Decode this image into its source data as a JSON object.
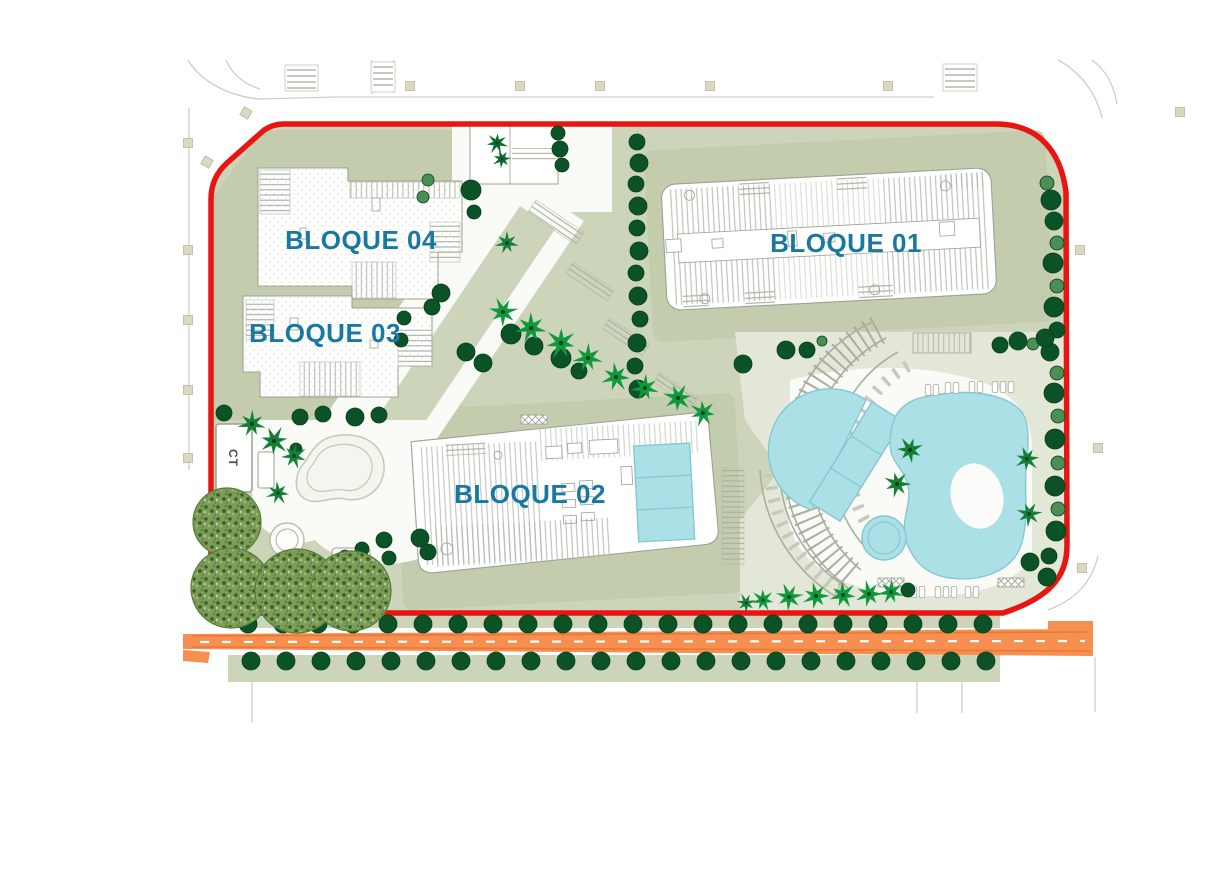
{
  "title": "Residential complex site plan",
  "labels": {
    "b01": "BLOQUE 01",
    "b02": "BLOQUE 02",
    "b03": "BLOQUE 03",
    "b04": "BLOQUE 04",
    "ct": "CT"
  },
  "colors": {
    "red": "#e81510",
    "sage": "#ccd5ba",
    "sageD": "#c3cdae",
    "deck": "#e3e7d8",
    "walk": "#fafbf7",
    "pool": "#abe0e7",
    "poolStroke": "#85c8d2",
    "road": "#f78f50",
    "roadEdge": "#e87a35",
    "label": "#1878a1",
    "bstroke": "#9ca294",
    "street": "#cdd0c5",
    "beige": "#ddd8c2",
    "treeDark": "#0c5227",
    "treeLight": "#4c8f54",
    "palmBright": "#10993c",
    "palmMid": "#157f38",
    "palmDark": "#0b6c2f",
    "canopyBase": "#7d9c58",
    "canopyEdge": "#55803a"
  },
  "trees": {
    "round": [
      [
        1047,
        183,
        7,
        "l"
      ],
      [
        1051,
        200,
        10,
        "d"
      ],
      [
        1054,
        221,
        9,
        "d"
      ],
      [
        1057,
        243,
        7,
        "l"
      ],
      [
        1053,
        263,
        10,
        "d"
      ],
      [
        1057,
        286,
        7,
        "l"
      ],
      [
        1054,
        307,
        10,
        "d"
      ],
      [
        1057,
        330,
        8,
        "d"
      ],
      [
        1050,
        352,
        9,
        "d"
      ],
      [
        1057,
        373,
        7,
        "l"
      ],
      [
        1054,
        393,
        10,
        "d"
      ],
      [
        1058,
        416,
        7,
        "l"
      ],
      [
        1055,
        439,
        10,
        "d"
      ],
      [
        1058,
        463,
        7,
        "l"
      ],
      [
        1055,
        486,
        10,
        "d"
      ],
      [
        1058,
        509,
        7,
        "l"
      ],
      [
        1056,
        531,
        10,
        "d"
      ],
      [
        1049,
        556,
        8,
        "d"
      ],
      [
        1047,
        577,
        9,
        "d"
      ],
      [
        1000,
        345,
        8,
        "d"
      ],
      [
        1018,
        341,
        9,
        "d"
      ],
      [
        1033,
        344,
        6,
        "l"
      ],
      [
        1045,
        338,
        9,
        "d"
      ],
      [
        637,
        142,
        8,
        "d"
      ],
      [
        639,
        163,
        9,
        "d"
      ],
      [
        636,
        184,
        8,
        "d"
      ],
      [
        638,
        206,
        9,
        "d"
      ],
      [
        637,
        228,
        8,
        "d"
      ],
      [
        639,
        251,
        9,
        "d"
      ],
      [
        636,
        273,
        8,
        "d"
      ],
      [
        638,
        296,
        9,
        "d"
      ],
      [
        640,
        319,
        8,
        "d"
      ],
      [
        637,
        343,
        9,
        "d"
      ],
      [
        635,
        366,
        8,
        "d"
      ],
      [
        638,
        389,
        9,
        "d"
      ],
      [
        441,
        293,
        9,
        "d"
      ],
      [
        432,
        307,
        8,
        "d"
      ],
      [
        466,
        352,
        9,
        "d"
      ],
      [
        483,
        363,
        9,
        "d"
      ],
      [
        511,
        334,
        10,
        "d"
      ],
      [
        534,
        346,
        9,
        "d"
      ],
      [
        561,
        358,
        10,
        "d"
      ],
      [
        579,
        371,
        8,
        "d"
      ],
      [
        404,
        318,
        7,
        "d"
      ],
      [
        401,
        340,
        7,
        "d"
      ],
      [
        428,
        180,
        6,
        "l"
      ],
      [
        423,
        197,
        6,
        "l"
      ],
      [
        471,
        190,
        10,
        "d"
      ],
      [
        474,
        212,
        7,
        "d"
      ],
      [
        558,
        133,
        7,
        "d"
      ],
      [
        560,
        149,
        8,
        "d"
      ],
      [
        562,
        165,
        7,
        "d"
      ],
      [
        786,
        350,
        9,
        "d"
      ],
      [
        807,
        350,
        8,
        "d"
      ],
      [
        822,
        341,
        5,
        "l"
      ],
      [
        743,
        364,
        9,
        "d"
      ],
      [
        224,
        413,
        8,
        "d"
      ],
      [
        300,
        417,
        8,
        "d"
      ],
      [
        323,
        414,
        8,
        "d"
      ],
      [
        355,
        417,
        9,
        "d"
      ],
      [
        379,
        415,
        8,
        "d"
      ],
      [
        296,
        449,
        6,
        "d"
      ],
      [
        384,
        540,
        8,
        "d"
      ],
      [
        362,
        549,
        7,
        "d"
      ],
      [
        389,
        558,
        7,
        "d"
      ],
      [
        345,
        556,
        6,
        "d"
      ],
      [
        420,
        538,
        9,
        "d"
      ],
      [
        428,
        552,
        8,
        "d"
      ],
      [
        908,
        590,
        7,
        "d"
      ],
      [
        1030,
        562,
        9,
        "d"
      ]
    ],
    "bottomRows": [
      {
        "y": 624,
        "x0": 248,
        "step": 35,
        "n": 22,
        "r": 9
      },
      {
        "y": 661,
        "x0": 251,
        "step": 35,
        "n": 22,
        "r": 9
      }
    ],
    "palms": [
      [
        503,
        312,
        15,
        "b"
      ],
      [
        531,
        328,
        16,
        "b"
      ],
      [
        561,
        343,
        16,
        "b"
      ],
      [
        588,
        358,
        15,
        "b"
      ],
      [
        616,
        377,
        15,
        "b"
      ],
      [
        645,
        388,
        14,
        "b"
      ],
      [
        678,
        398,
        15,
        "b"
      ],
      [
        703,
        413,
        14,
        "b"
      ],
      [
        507,
        243,
        12,
        "m"
      ],
      [
        497,
        143,
        11,
        "d"
      ],
      [
        502,
        159,
        10,
        "d"
      ],
      [
        252,
        424,
        14,
        "m"
      ],
      [
        274,
        441,
        15,
        "m"
      ],
      [
        294,
        456,
        13,
        "m"
      ],
      [
        278,
        493,
        12,
        "m"
      ],
      [
        243,
        572,
        13,
        "m"
      ],
      [
        306,
        568,
        13,
        "m"
      ],
      [
        320,
        588,
        12,
        "m"
      ],
      [
        260,
        598,
        12,
        "m"
      ],
      [
        910,
        450,
        14,
        "m"
      ],
      [
        897,
        484,
        14,
        "m"
      ],
      [
        1027,
        459,
        13,
        "m"
      ],
      [
        1029,
        514,
        13,
        "m"
      ],
      [
        746,
        603,
        10,
        "m"
      ],
      [
        763,
        600,
        12,
        "b"
      ],
      [
        789,
        597,
        14,
        "b"
      ],
      [
        816,
        596,
        14,
        "b"
      ],
      [
        843,
        595,
        14,
        "b"
      ],
      [
        869,
        594,
        14,
        "b"
      ],
      [
        891,
        592,
        13,
        "b"
      ]
    ],
    "canopy": [
      [
        227,
        522,
        34
      ],
      [
        231,
        588,
        40
      ],
      [
        297,
        591,
        42
      ],
      [
        351,
        591,
        40
      ]
    ]
  },
  "loungers": [
    [
      928,
      390
    ],
    [
      936,
      390
    ],
    [
      948,
      388
    ],
    [
      956,
      388
    ],
    [
      972,
      387
    ],
    [
      980,
      387
    ],
    [
      995,
      387
    ],
    [
      1003,
      387
    ],
    [
      1011,
      387
    ],
    [
      914,
      592
    ],
    [
      922,
      592
    ],
    [
      938,
      592
    ],
    [
      946,
      592
    ],
    [
      954,
      592
    ],
    [
      968,
      592
    ],
    [
      976,
      592
    ]
  ],
  "pergolas": [
    [
      878,
      578
    ],
    [
      998,
      578
    ],
    [
      521,
      415
    ]
  ],
  "streetSquares": [
    [
      410,
      86,
      0
    ],
    [
      520,
      86,
      0
    ],
    [
      600,
      86,
      0
    ],
    [
      710,
      86,
      0
    ],
    [
      888,
      86,
      0
    ],
    [
      188,
      143,
      0
    ],
    [
      188,
      250,
      0
    ],
    [
      188,
      320,
      0
    ],
    [
      188,
      390,
      0
    ],
    [
      188,
      458,
      0
    ],
    [
      246,
      113,
      30
    ],
    [
      207,
      162,
      30
    ],
    [
      1180,
      112,
      0
    ],
    [
      1080,
      250,
      0
    ],
    [
      1098,
      448,
      0
    ],
    [
      1082,
      568,
      0
    ]
  ]
}
